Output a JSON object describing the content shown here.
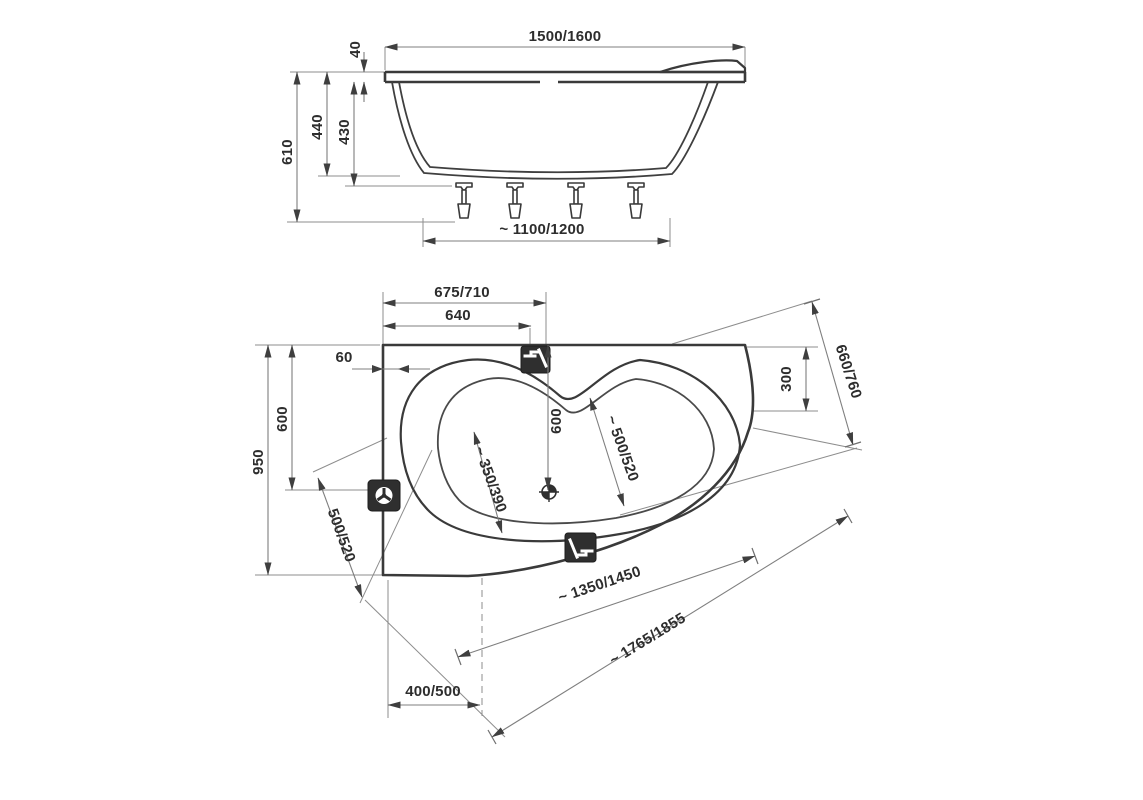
{
  "title": "bathtub-technical-drawing",
  "colors": {
    "background": "#ffffff",
    "outline": "#3a3a3a",
    "dimension_lines": "#7f7f7f",
    "text": "#2d2d2d",
    "icon_background": "#2f2f2f"
  },
  "side_view": {
    "dims": {
      "length_top": "1500/1600",
      "rim_thickness": "40",
      "height_total": "610",
      "depth_outer": "440",
      "depth_inner": "430",
      "base_span": "~ 1100/1200"
    }
  },
  "plan_view": {
    "dims": {
      "faucet_edge_offset": "675/710",
      "faucet_center_offset": "640",
      "wall_gap": "60",
      "drain_axis_from_wall": "600",
      "width_total": "950",
      "end_width_left": "500/520",
      "basin_width_left": "~ 350/390",
      "drain_center_depth": "600",
      "basin_width_right": "~ 500/520",
      "corner_depth": "300",
      "angled_edge_right": "660/760",
      "front_chord": "~ 1350/1450",
      "overall_diagonal": "~ 1765/1855",
      "corner_offset_bottom": "400/500"
    },
    "icons": {
      "top_faucet": "faucet-icon",
      "bottom_faucet": "faucet-icon",
      "overflow": "overflow-drain-icon",
      "drain": "drain-cross-icon"
    }
  }
}
